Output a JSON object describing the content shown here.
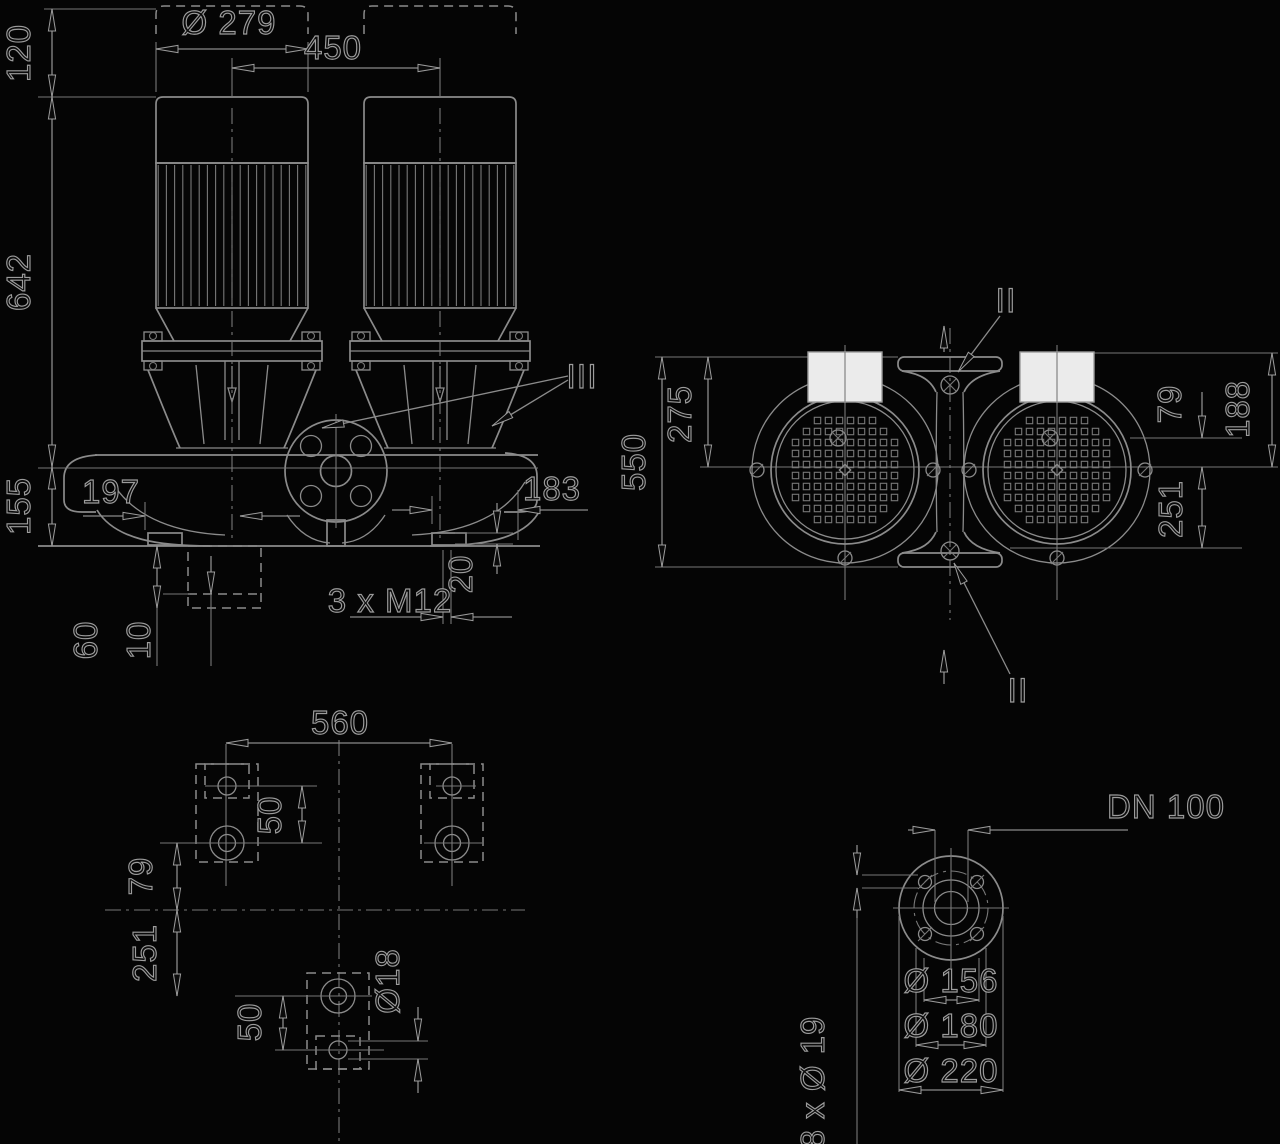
{
  "colors": {
    "background": "#050505",
    "line": "#8b8b8b",
    "label_outline": "#9c9c9c",
    "terminal_box_fill": "#ebebeb"
  },
  "front_view": {
    "dims": {
      "height_above": "120",
      "motor_height": "642",
      "base_height": "155",
      "motor_diameter": "Ø 279",
      "motor_spacing": "450",
      "left_port_offset": "197",
      "right_port_offset": "183",
      "foot_pad_thickness": "20",
      "tapped_holes": "3 x M12",
      "foundation_depth": "60",
      "grout_thickness": "10"
    },
    "section_label": "III"
  },
  "top_view": {
    "dims": {
      "port_to_port": "550",
      "port_face_to_axis": "275",
      "axis_offset": "79",
      "face_to_axis": "188",
      "axis_to_rear": "251"
    },
    "section_label_top": "II",
    "section_label_bottom": "II"
  },
  "plan_view": {
    "dims": {
      "bolt_spacing": "560",
      "front_hole_offset": "50",
      "front_to_center": "79",
      "center_to_rear": "251",
      "rear_hole_offset": "50",
      "hole_diameter": "Ø18"
    }
  },
  "flange_view": {
    "nominal_diameter": "DN 100",
    "dims": {
      "raised_face": "Ø 156",
      "bolt_circle": "Ø 180",
      "outer_diameter": "Ø 220",
      "bolt_holes": "8 x Ø 19"
    }
  }
}
